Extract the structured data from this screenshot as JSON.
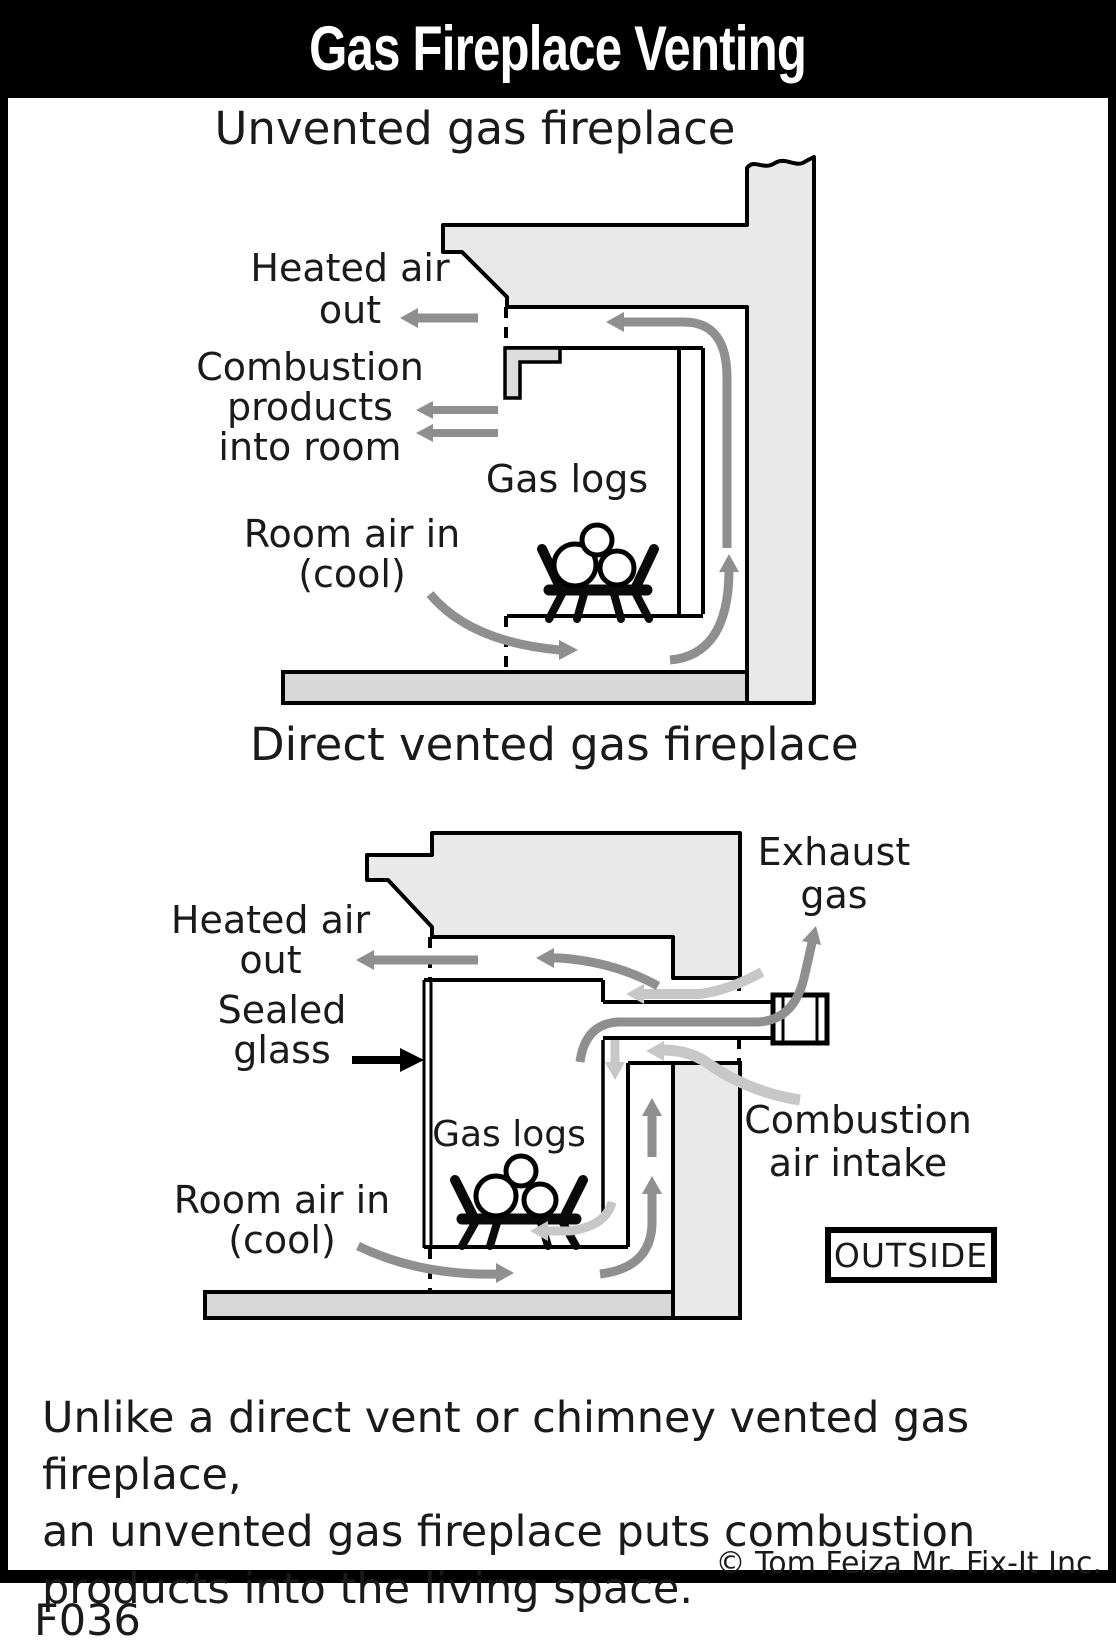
{
  "header": {
    "title": "Gas Fireplace Venting"
  },
  "diagram1": {
    "title": "Unvented gas fireplace",
    "labels": {
      "heated_air_line1": "Heated air",
      "heated_air_line2": "out",
      "combustion_line1": "Combustion",
      "combustion_line2": "products",
      "combustion_line3": "into room",
      "gas_logs": "Gas logs",
      "room_air_line1": "Room air in",
      "room_air_line2": "(cool)"
    }
  },
  "diagram2": {
    "title": "Direct vented gas fireplace",
    "labels": {
      "exhaust_line1": "Exhaust",
      "exhaust_line2": "gas",
      "heated_air_line1": "Heated air",
      "heated_air_line2": "out",
      "sealed_line1": "Sealed",
      "sealed_line2": "glass",
      "gas_logs": "Gas logs",
      "room_air_line1": "Room air in",
      "room_air_line2": "(cool)",
      "combustion_line1": "Combustion",
      "combustion_line2": "air intake",
      "outside": "OUTSIDE"
    }
  },
  "footer": {
    "caption_lines": [
      "Unlike a direct vent or chimney vented gas fireplace,",
      "an unvented gas fireplace puts combustion",
      "products into the living space."
    ],
    "copyright": "© Tom Feiza Mr. Fix-It Inc.",
    "figure_code": "F036"
  },
  "colors": {
    "wall_fill": "#e9e9e9",
    "floor_fill": "#d7d7d7",
    "arrow_dark": "#8f8f8f",
    "arrow_light": "#c7c7c7",
    "line": "#000000"
  }
}
